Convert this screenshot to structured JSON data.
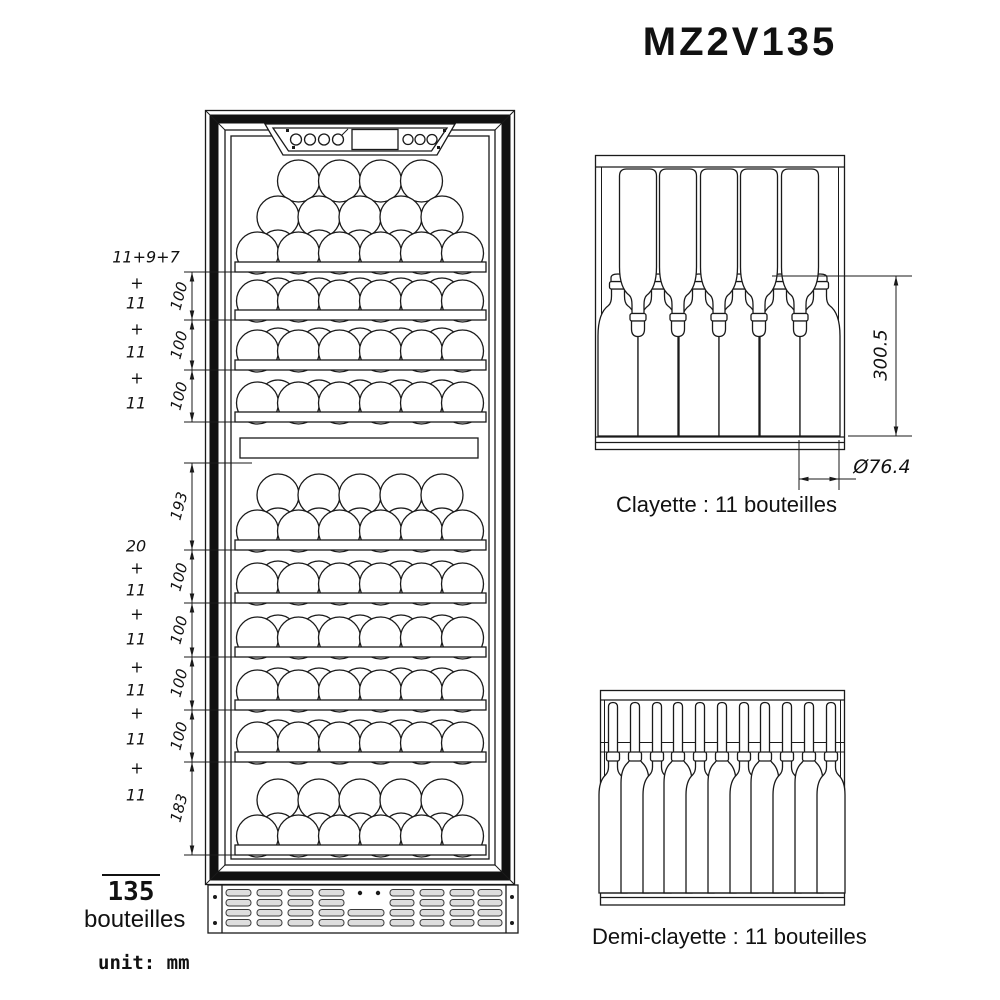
{
  "title": "MZ2V135",
  "unit_note": "unit: mm",
  "front_view": {
    "upper_counts": [
      "11+9+7",
      "+",
      "11",
      "+",
      "11",
      "+",
      "11"
    ],
    "upper_dims": [
      "100",
      "100",
      "100"
    ],
    "lower_counts": [
      "20",
      "+",
      "11",
      "+",
      "11",
      "+",
      "11",
      "+",
      "11",
      "+",
      "11"
    ],
    "lower_dims": [
      "193",
      "100",
      "100",
      "100",
      "100",
      "183"
    ],
    "capacity_value": "135",
    "capacity_unit": "bouteilles"
  },
  "clayette": {
    "caption": "Clayette : 11 bouteilles",
    "height_dim": "300.5",
    "diameter_dim": "Ø76.4"
  },
  "demi_clayette": {
    "caption": "Demi-clayette : 11 bouteilles"
  }
}
